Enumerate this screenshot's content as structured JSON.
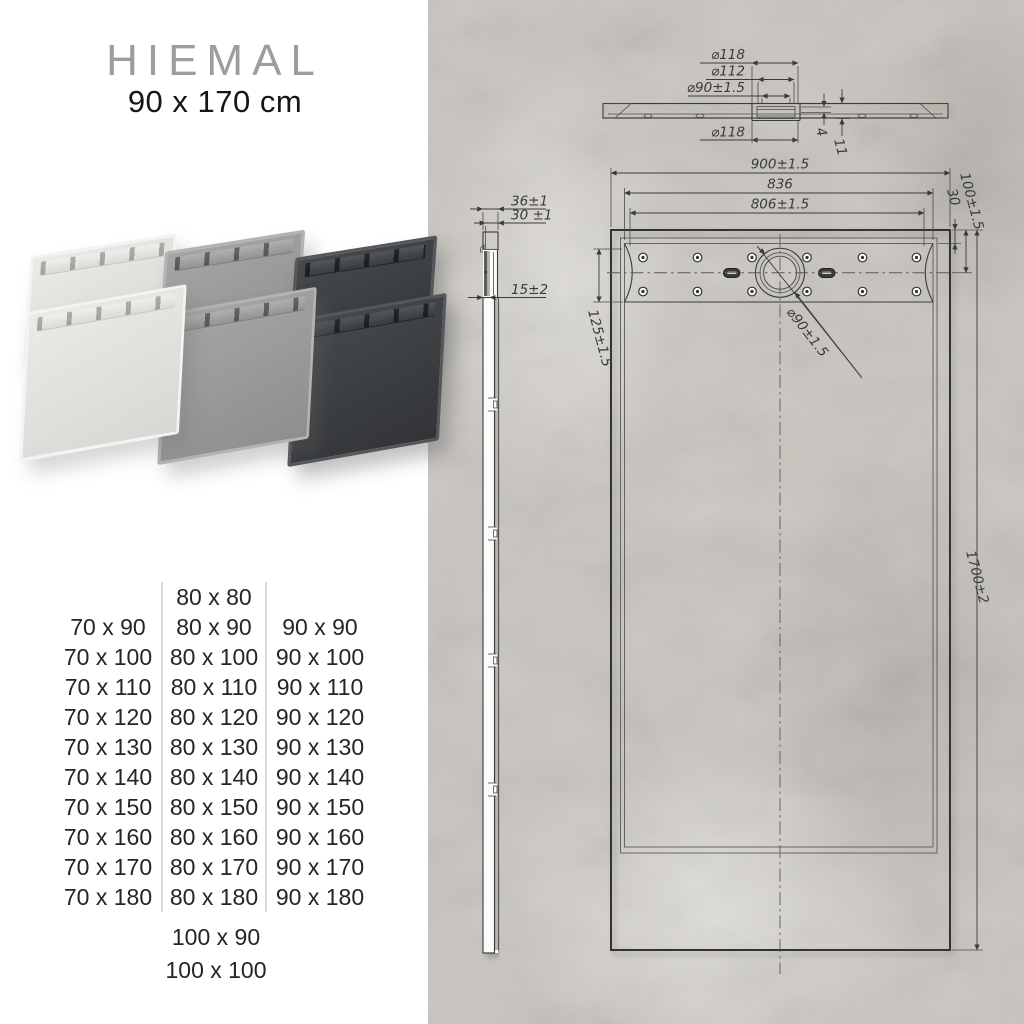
{
  "header": {
    "title": "HIEMAL",
    "subtitle": "90 x 170 cm"
  },
  "collage": {
    "tray_colors": [
      {
        "name": "white",
        "hex": "#e8e6e3"
      },
      {
        "name": "grey",
        "hex": "#9c9c9b"
      },
      {
        "name": "anthracite",
        "hex": "#3d3f42"
      }
    ]
  },
  "sizes": {
    "col1": [
      "70 x 90",
      "70 x 100",
      "70 x 110",
      "70 x 120",
      "70 x 130",
      "70 x 140",
      "70 x 150",
      "70 x 160",
      "70 x 170",
      "70 x 180"
    ],
    "col2": [
      "80 x 80",
      "80 x 90",
      "80 x 100",
      "80 x 110",
      "80 x 120",
      "80 x 130",
      "80 x 140",
      "80 x 150",
      "80 x 160",
      "80 x 170",
      "80 x 180"
    ],
    "col3": [
      "90 x 90",
      "90 x 100",
      "90 x 110",
      "90 x 120",
      "90 x 130",
      "90 x 140",
      "90 x 150",
      "90 x 160",
      "90 x 170",
      "90 x 180"
    ],
    "extra": [
      "100 x 90",
      "100 x 100"
    ]
  },
  "drawing": {
    "colors": {
      "concrete": "#c8c5bf",
      "line": "#3b3b3b",
      "paper": "#fbfbf9"
    },
    "dims": {
      "sec_d118_top": "⌀118",
      "sec_d112": "⌀112",
      "sec_d90": "⌀90±1.5",
      "sec_d118_bottom": "⌀118",
      "sec_step": "4",
      "sec_thickness": "11",
      "side_w36": "36±1",
      "side_w30": "30 ±1",
      "side_lip15": "15±2",
      "plan_w900": "900±1.5",
      "plan_w836": "836",
      "plan_w806": "806±1.5",
      "plan_off30": "30",
      "plan_off100": "100±1.5",
      "plan_off125": "125±1.5",
      "plan_drain": "⌀90±1.5",
      "plan_len1700": "1700±2"
    }
  }
}
